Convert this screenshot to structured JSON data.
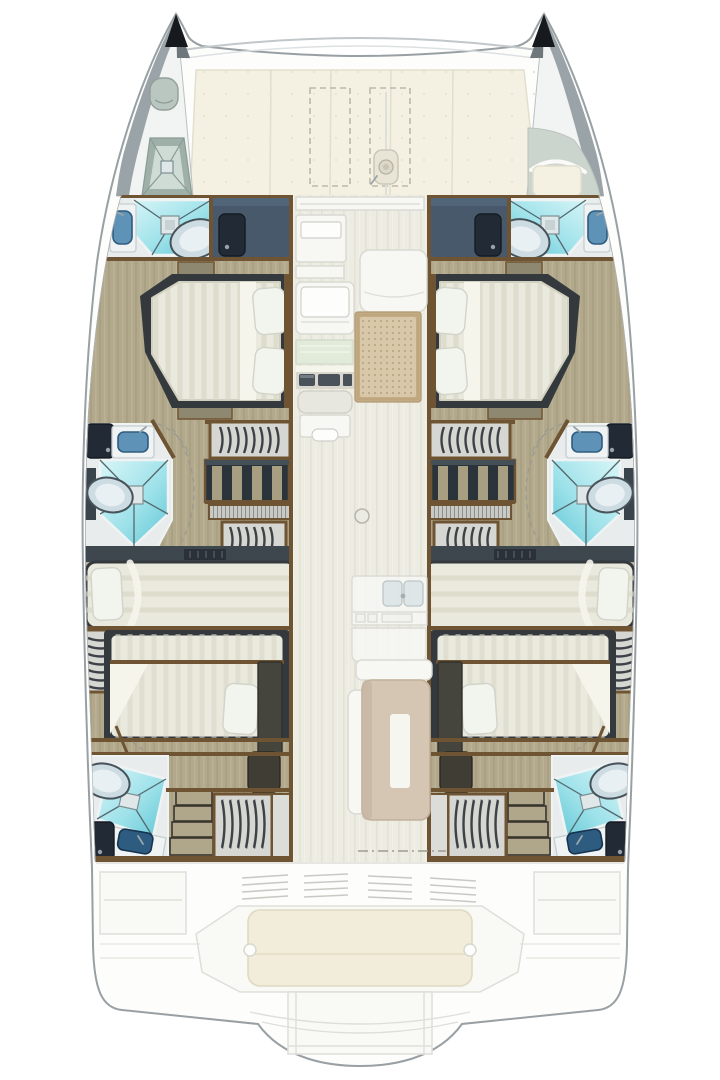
{
  "plan": {
    "vessel_type": "catamaran",
    "view": "overhead-deck-floor-plan",
    "cabins": [
      "port-forward-island-double",
      "port-mid-double",
      "port-aft-double",
      "starboard-forward-island-double",
      "starboard-mid-double",
      "starboard-aft-double"
    ],
    "heads": [
      "port-forward-head",
      "port-mid-head",
      "port-aft-head",
      "starboard-forward-head",
      "starboard-mid-head",
      "starboard-aft-head"
    ],
    "shared_features": [
      "bow-anchor-lockers",
      "foredeck-sunpad-cushions",
      "foredeck-storage-hatches",
      "anchor-windlass",
      "saloon-chart-table",
      "helm-instrument-console",
      "saloon-lounge-rug",
      "mast-post",
      "galley-double-sink",
      "dining-table",
      "hanging-lockers",
      "companionway-steps",
      "aft-cockpit-bench",
      "swim-platform-steps"
    ]
  },
  "palette": {
    "deck_white": "#fdfdfc",
    "hull_outline": "#98a0a4",
    "hull_inner_line": "#aab0b3",
    "ghost_fill": "#f9f9f6",
    "ghost_stroke": "#dfdfd9",
    "louver": "#c9c9c4",
    "cushion_cream": "#f4f1e3",
    "cushion_edge": "#e3dfcd",
    "bench_cushion": "#f2edda",
    "bench_cushion_edge": "#e0d9c0",
    "dash_locker": "#bdb9a8",
    "beam_line": "#c2c7ca",
    "tip_black": "#16191d",
    "bow_gray": "#9aa3a7",
    "bow_deck": "#f2f4f3",
    "hatch_sage": "#9fb0a9",
    "hatch_sage_light": "#cfdbd5",
    "sage": "#ccd5cd",
    "wood_trim": "#6f5433",
    "wood_floor": "#b2a98c",
    "wood_floor_dark": "#a49b7d",
    "wood_floor_light": "#c3ba9c",
    "saloon_floor": "#edece3",
    "saloon_floor_line": "#e4e2d5",
    "bath_floor": "#e8ecec",
    "counter_white": "#f0f3f3",
    "slate": "#47596b",
    "slate_light": "#54687c",
    "door_dark": "#222b35",
    "metal": "#9aa4a8",
    "shower_light": "#d9f6f8",
    "shower_mid": "#9fe2ea",
    "shower_deep": "#5fc6d4",
    "shower_line": "#55686e",
    "drain": "#dfe7e8",
    "sink_blue": "#5e92b6",
    "sink_blue_dark": "#2e5c80",
    "toilet_fill": "#cddbe2",
    "toilet_inner": "#e9f0f4",
    "toilet_stroke": "#47525a",
    "mattress": "#e9e9dd",
    "mattress_stripe": "#d7d6c6",
    "mattress_rim": "#34393e",
    "sheet_white": "#f5f5ec",
    "pillow": "#f2f4ee",
    "pillow_edge": "#d2d4ca",
    "bench_khaki": "#8f8871",
    "locker_bg": "#d6d6d2",
    "hanger_dark": "#3c4246",
    "shelf_dark": "#2c343b",
    "shelf_divider": "#a89f83",
    "steps_tread": "#b0a78a",
    "steps_edge": "#38352e",
    "slate_col": "#45453d",
    "table_dark": "#403e34",
    "headboard": "#3e474e",
    "furn_white": "#f7f7f4",
    "furn_edge": "#d9d9d3",
    "green_counter": "#e2ead9",
    "instrument_dark": "#49525a",
    "rug_border": "#c3ab84",
    "rug_field": "#d8c7a9",
    "rug_dot": "#a8946f",
    "mast_fill": "#ebebe3",
    "table_tan": "#d5c5b3",
    "table_tan_edge": "#c2b09a",
    "table_inner": "#f7f5f0",
    "dash_line": "#9b9b92"
  }
}
